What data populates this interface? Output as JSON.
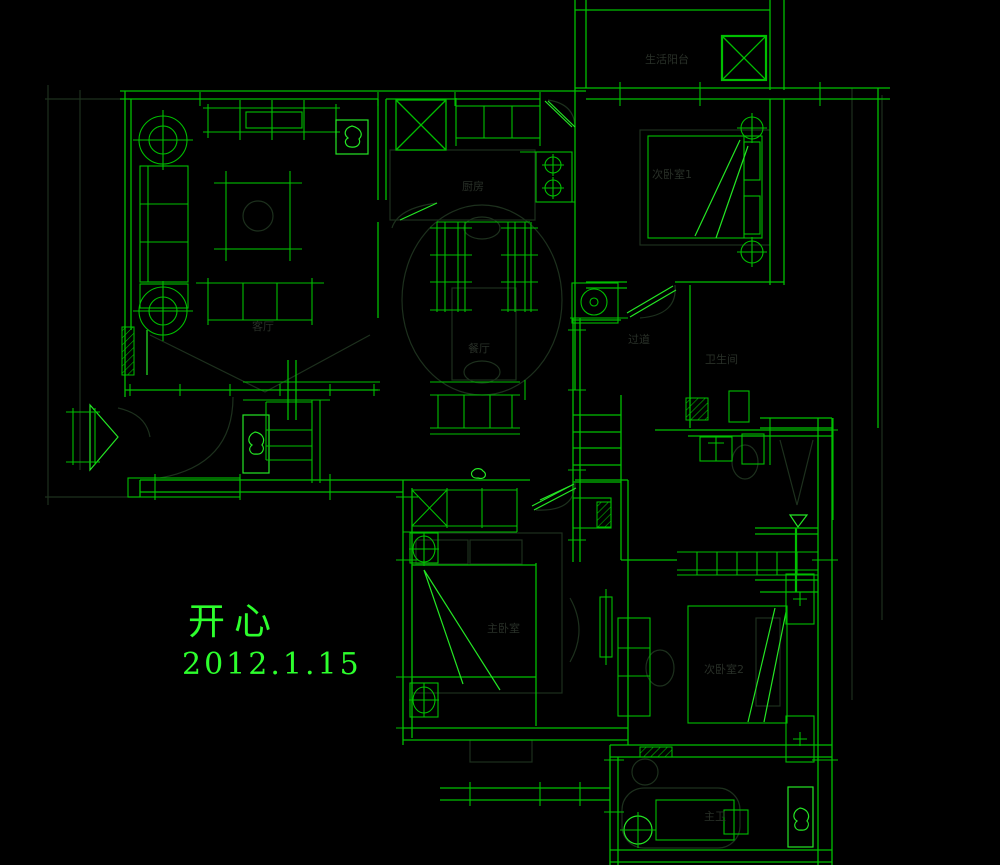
{
  "drawing": {
    "kind": "cad-floor-plan",
    "background": "#000000"
  },
  "colors": {
    "background": "#000000",
    "line": "#00bf00",
    "bright": "#24e524",
    "dim": "#1d301d",
    "faint-text": "#31392f",
    "annotation": "#2dff2d"
  },
  "annotations": {
    "title": "开心",
    "date": "2012.1.15"
  },
  "room_labels": [
    {
      "id": "living-room",
      "text": "客厅",
      "x": 252,
      "y": 330
    },
    {
      "id": "kitchen",
      "text": "厨房",
      "x": 462,
      "y": 190
    },
    {
      "id": "dining-room",
      "text": "餐厅",
      "x": 468,
      "y": 352
    },
    {
      "id": "utility-balcony",
      "text": "生活阳台",
      "x": 645,
      "y": 63
    },
    {
      "id": "bedroom-1",
      "text": "次卧室1",
      "x": 652,
      "y": 178
    },
    {
      "id": "corridor",
      "text": "过道",
      "x": 628,
      "y": 343
    },
    {
      "id": "bathroom-1",
      "text": "卫生间",
      "x": 705,
      "y": 363
    },
    {
      "id": "master-bedroom",
      "text": "主卧室",
      "x": 487,
      "y": 632
    },
    {
      "id": "bedroom-2",
      "text": "次卧室2",
      "x": 704,
      "y": 673
    },
    {
      "id": "master-bath",
      "text": "主卫",
      "x": 704,
      "y": 820
    }
  ]
}
